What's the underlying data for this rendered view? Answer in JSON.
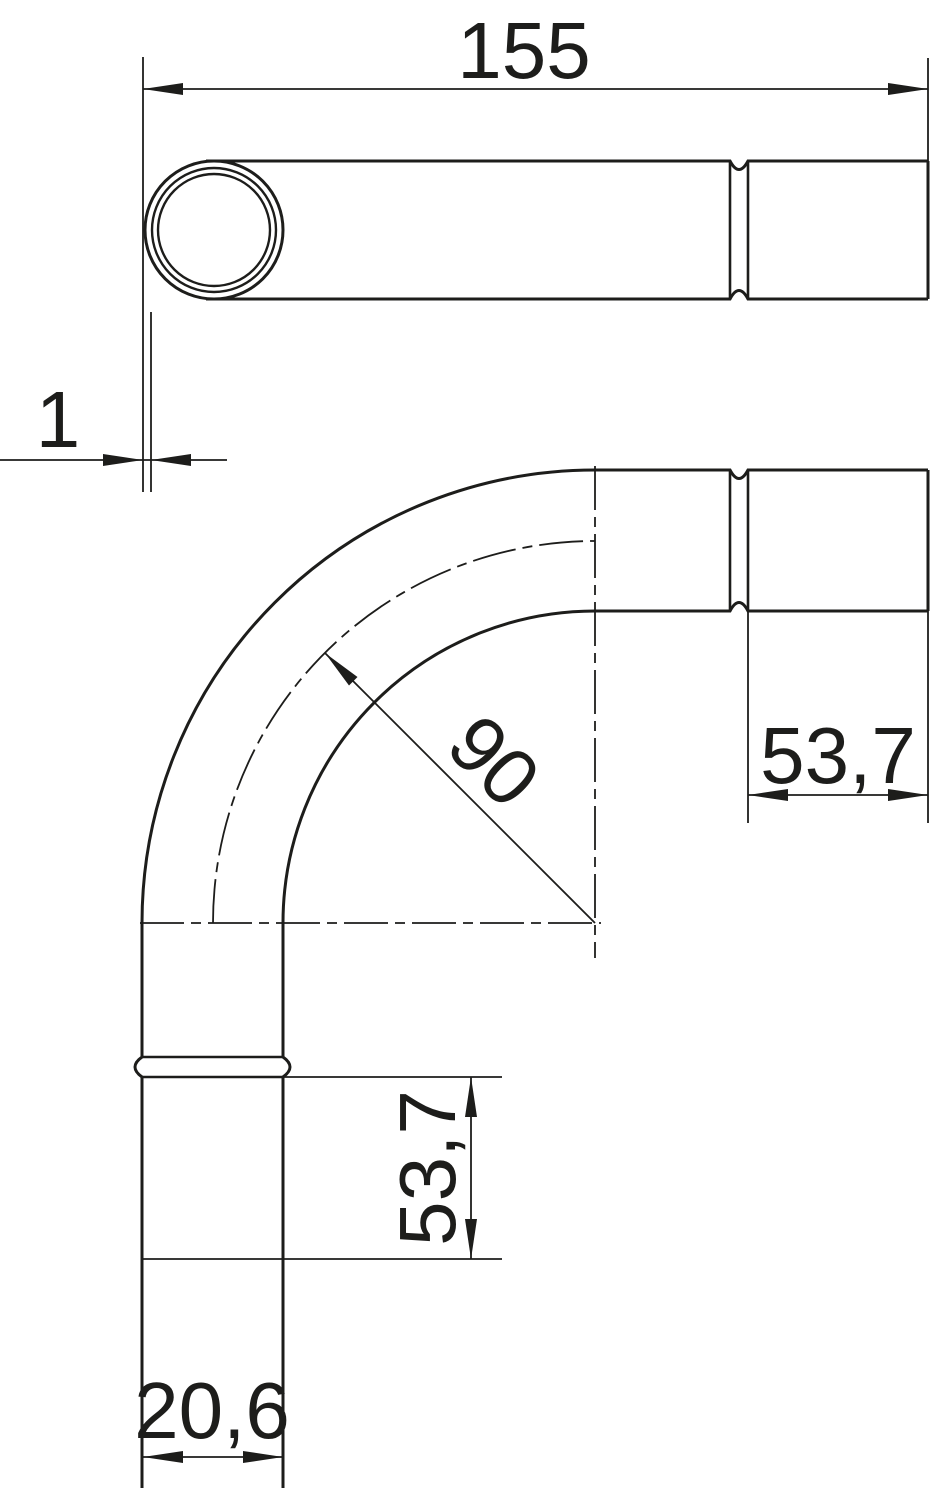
{
  "meta": {
    "type": "technical-drawing",
    "subject": "90-degree conduit pipe bend, two views",
    "background_color": "#ffffff",
    "line_color": "#1d1d1b"
  },
  "dimensions": {
    "overall_length": {
      "value": "155"
    },
    "wall_thickness": {
      "value": "1"
    },
    "bend_radius": {
      "value": "90"
    },
    "socket_length_right": {
      "value": "53,7"
    },
    "socket_length_bottom": {
      "value": "53,7"
    },
    "outer_diameter": {
      "value": "20,6"
    }
  }
}
